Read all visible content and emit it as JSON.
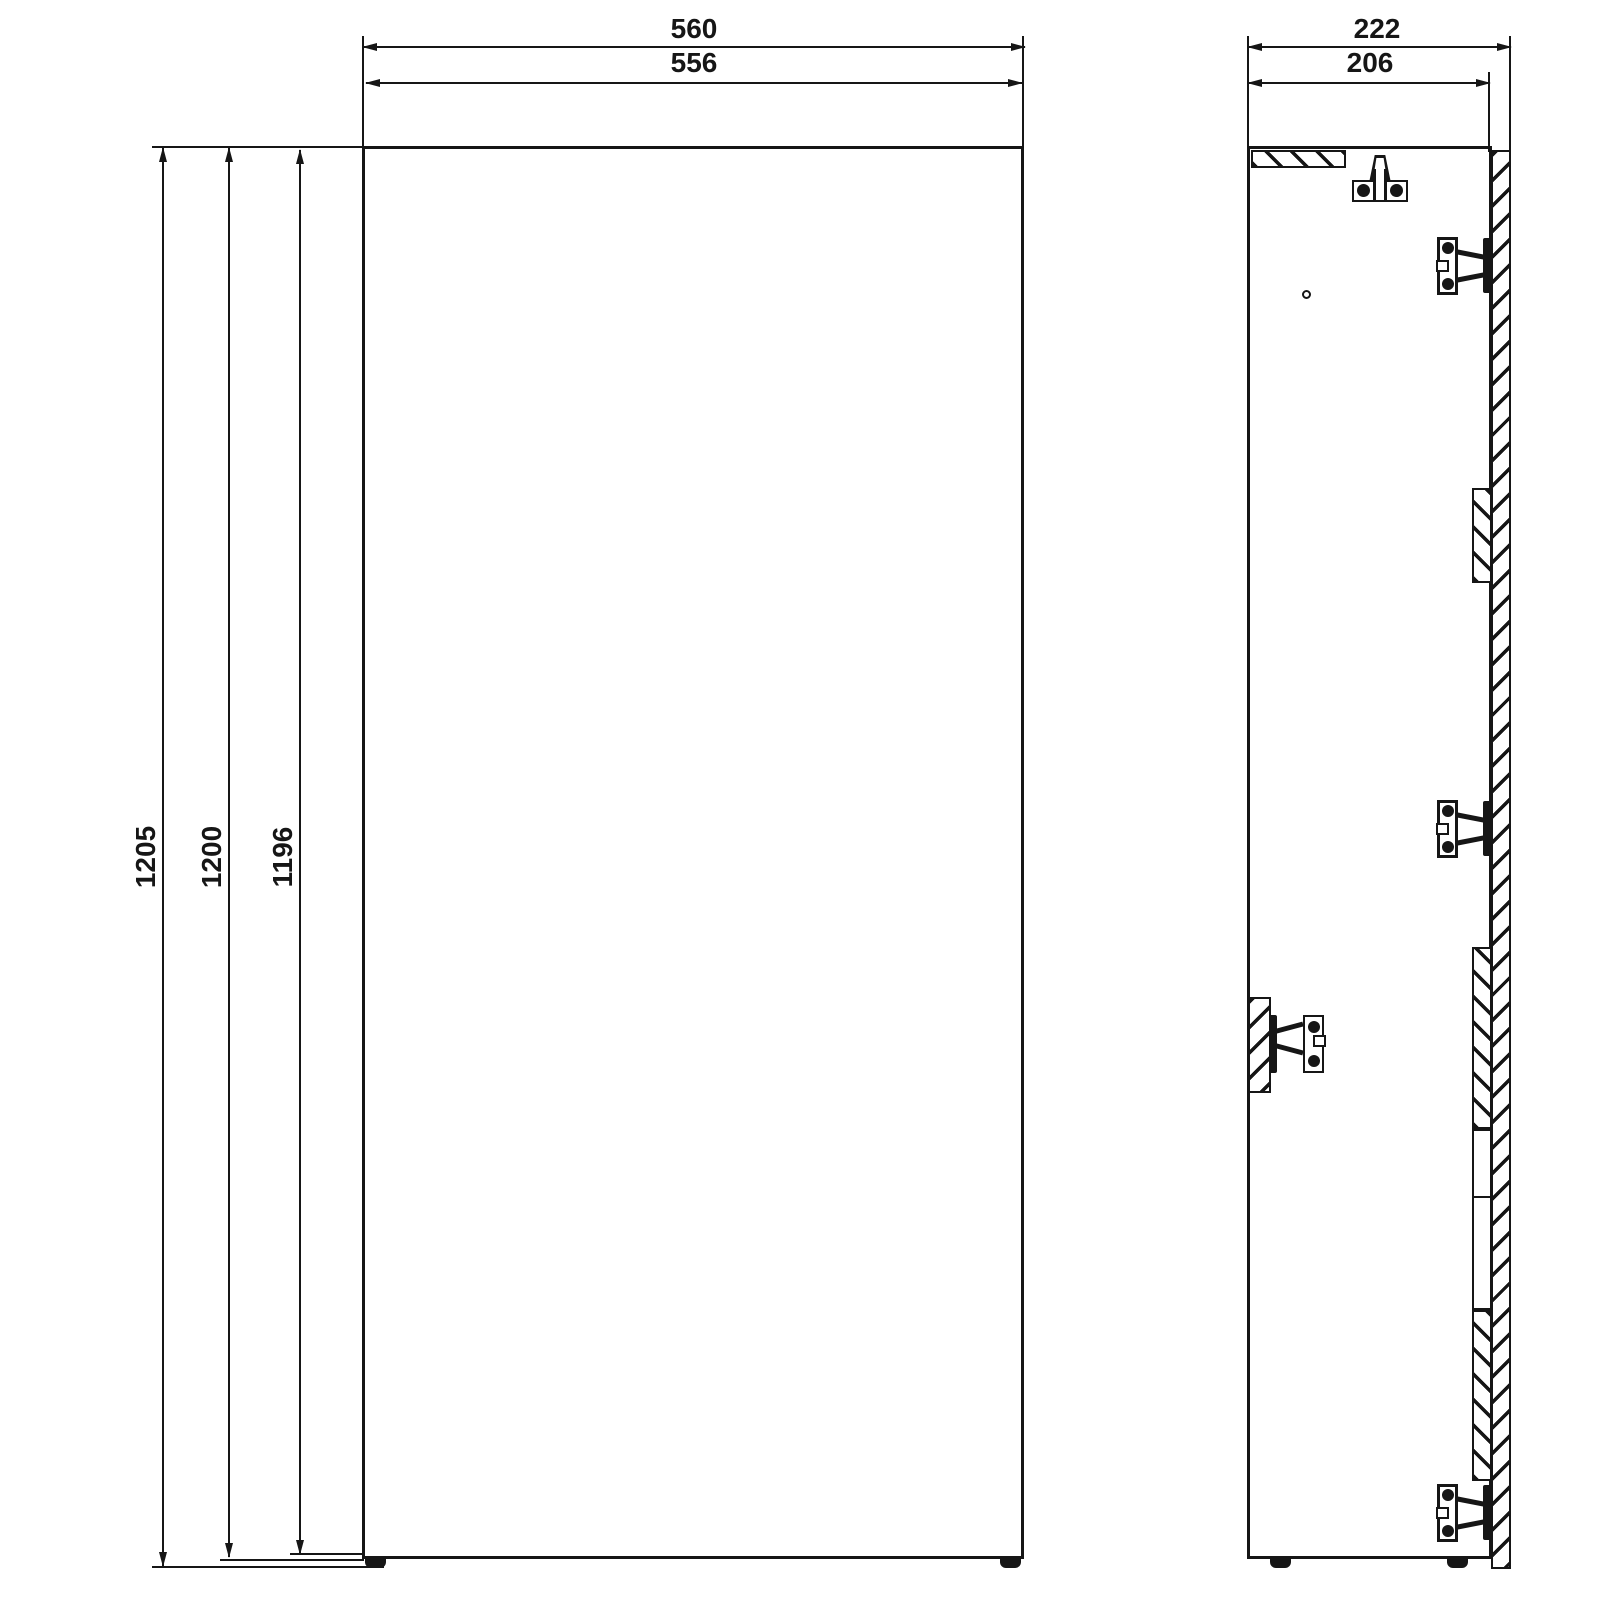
{
  "drawing": {
    "type": "technical-dimension-drawing",
    "background_color": "#ffffff",
    "line_color": "#161616",
    "front_view": {
      "width_dimensions": [
        {
          "label": "560"
        },
        {
          "label": "556"
        }
      ],
      "height_dimensions": [
        {
          "label": "1205"
        },
        {
          "label": "1200"
        },
        {
          "label": "1196"
        }
      ]
    },
    "side_view": {
      "depth_dimensions": [
        {
          "label": "222"
        },
        {
          "label": "206"
        }
      ]
    }
  }
}
